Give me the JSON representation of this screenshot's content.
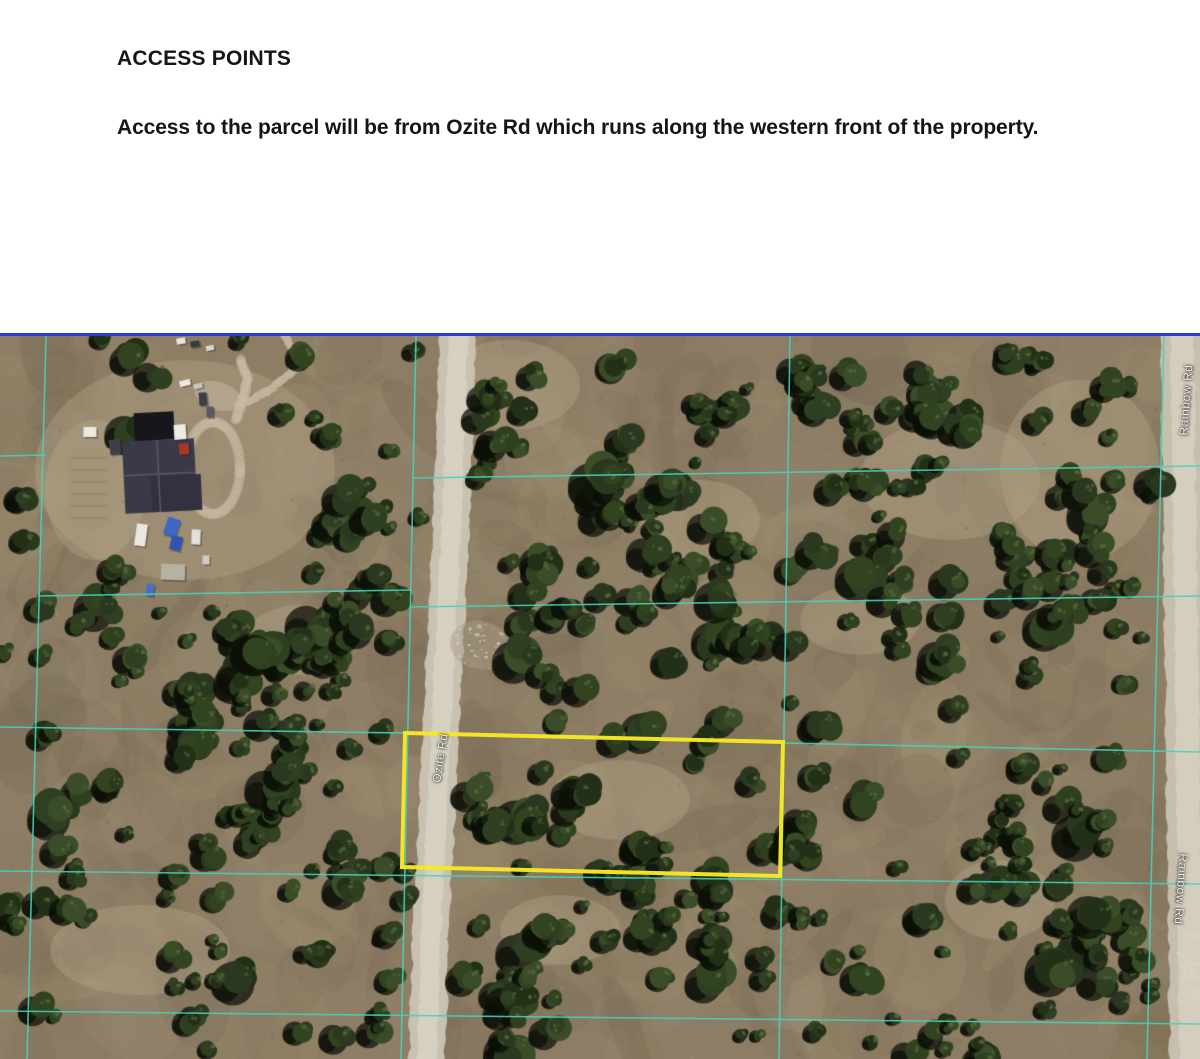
{
  "document": {
    "heading": "ACCESS POINTS",
    "body": "Access to the parcel will be from Ozite Rd which runs along the western front of the property."
  },
  "map": {
    "road_labels": {
      "ozite": "Ozite Rd",
      "rainbow_top": "Rainbow Rd",
      "rainbow_bottom": "Rainbow Rd"
    },
    "colors": {
      "divider_line": "#2b3cd4",
      "grid_line": "#46d2b9",
      "parcel_outline": "#f7e824"
    }
  }
}
